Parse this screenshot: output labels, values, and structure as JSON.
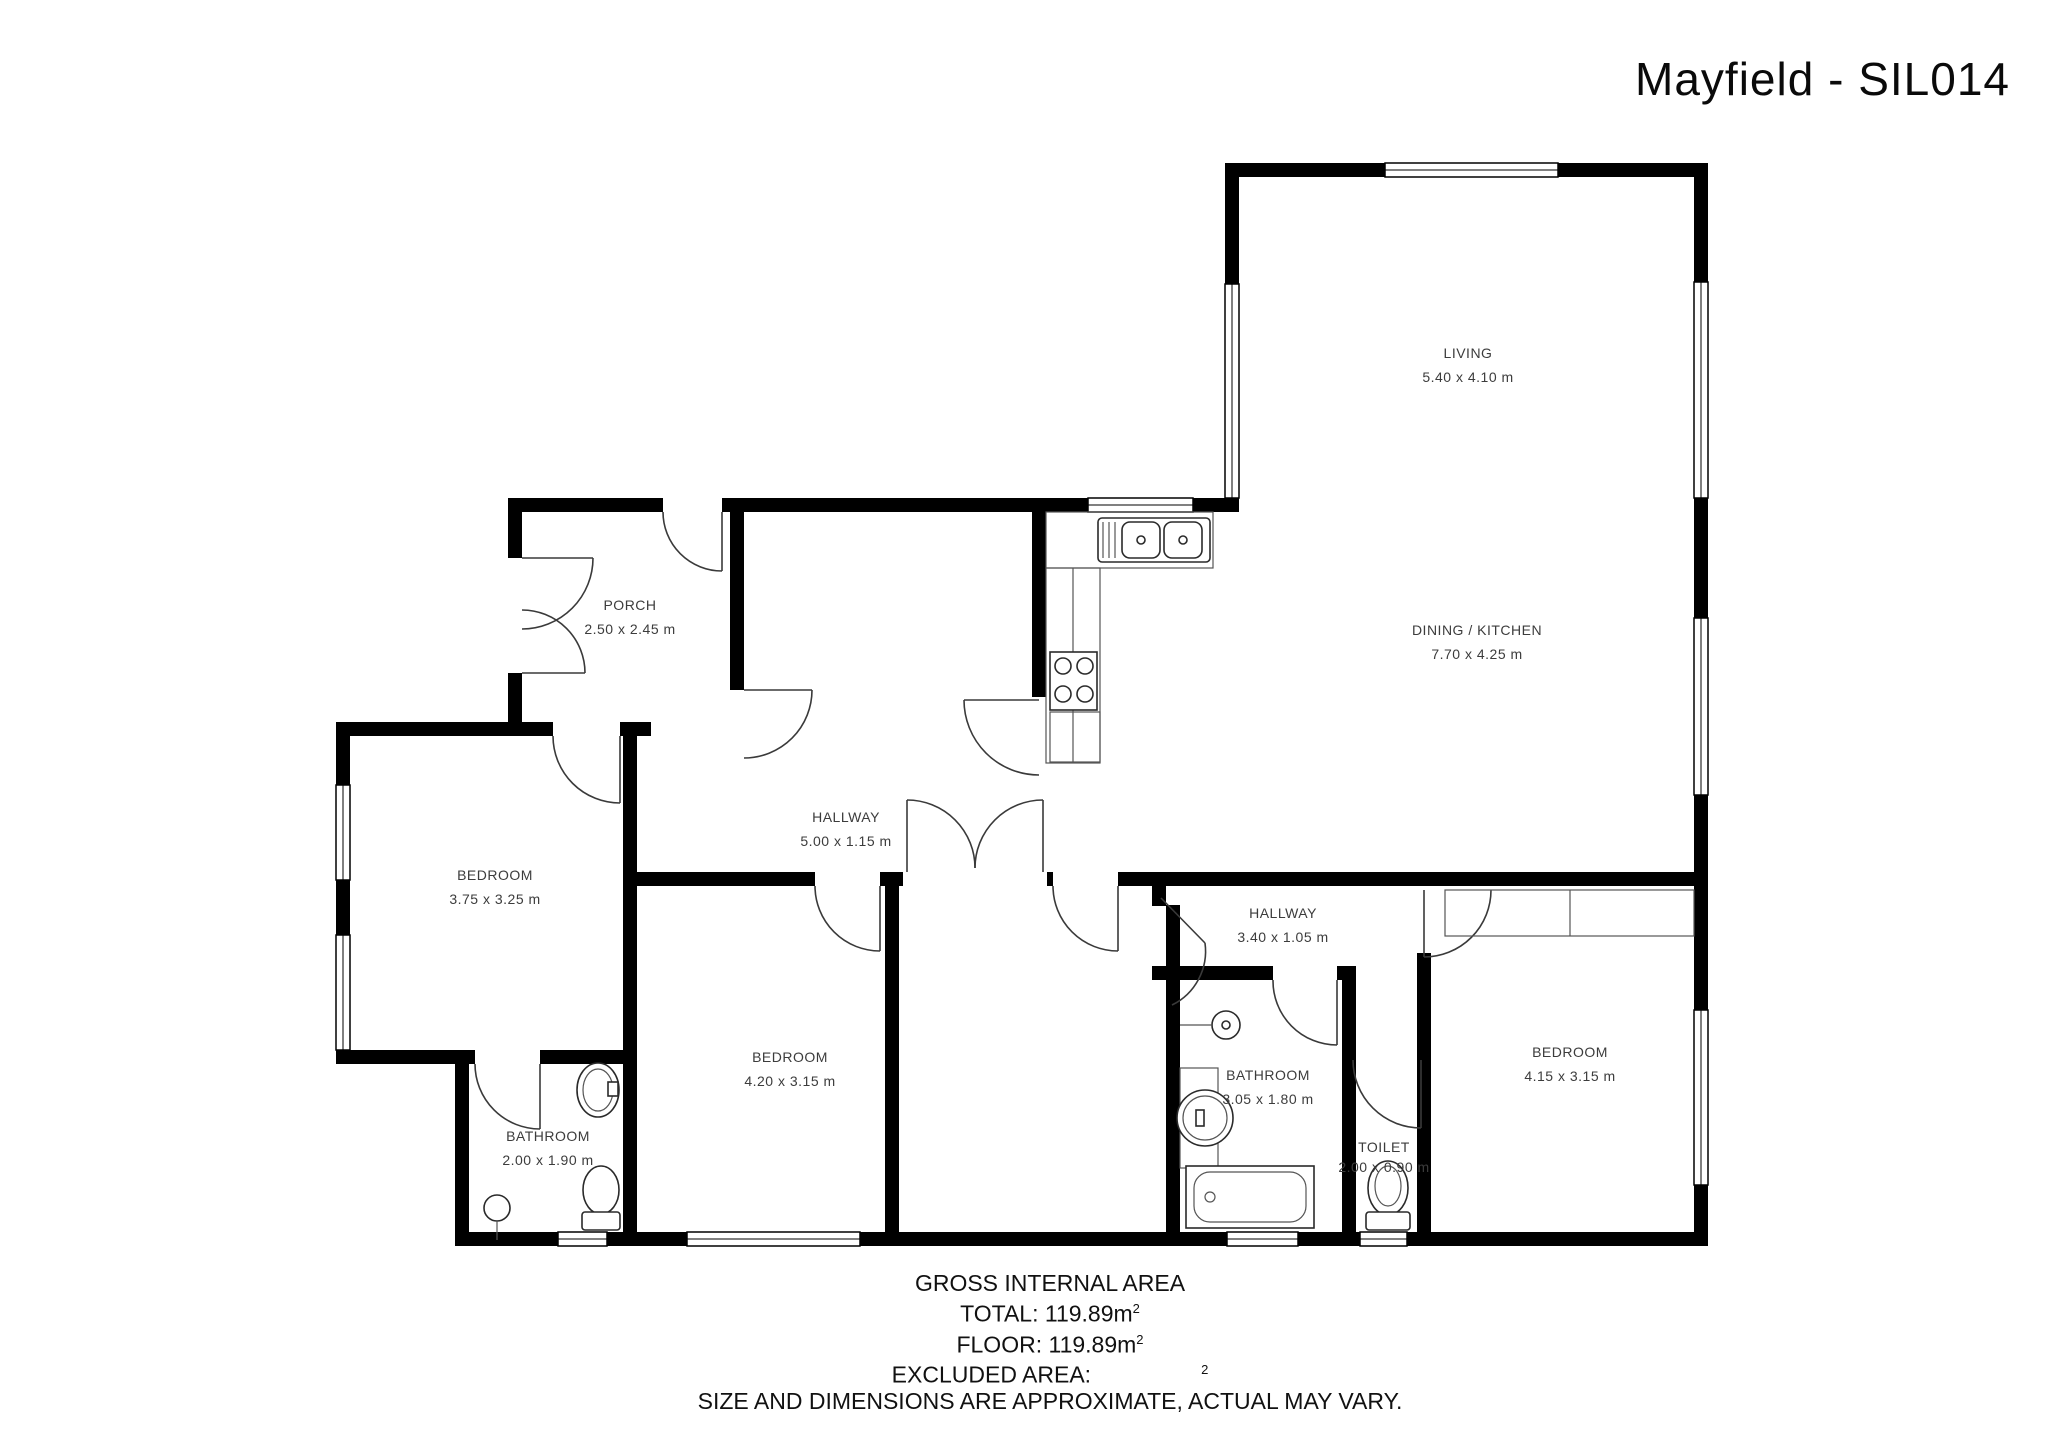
{
  "title": "Mayfield - SIL014",
  "rooms": [
    {
      "name": "LIVING",
      "dims": "5.40 x 4.10 m"
    },
    {
      "name": "DINING / KITCHEN",
      "dims": "7.70 x 4.25 m"
    },
    {
      "name": "PORCH",
      "dims": "2.50 x 2.45 m"
    },
    {
      "name": "HALLWAY",
      "dims": "5.00 x 1.15 m"
    },
    {
      "name": "HALLWAY",
      "dims": "3.40 x 1.05 m"
    },
    {
      "name": "BEDROOM",
      "dims": "3.75 x 3.25 m"
    },
    {
      "name": "BEDROOM",
      "dims": "4.20 x 3.15 m"
    },
    {
      "name": "BEDROOM",
      "dims": "4.15 x 3.15 m"
    },
    {
      "name": "BATHROOM",
      "dims": "2.00 x 1.90 m"
    },
    {
      "name": "BATHROOM",
      "dims": "3.05 x 1.80 m"
    },
    {
      "name": "TOILET",
      "dims": "2.00 x 0.90 m"
    }
  ],
  "footer": {
    "heading": "GROSS INTERNAL AREA",
    "total_label": "TOTAL: 119.89m",
    "floor_label": "FLOOR: 119.89m",
    "sup": "2",
    "excluded_label": "EXCLUDED AREA:",
    "excluded_sup": "2",
    "disclaimer": "SIZE AND DIMENSIONS ARE APPROXIMATE, ACTUAL MAY VARY."
  },
  "colors": {
    "wall": "#000000",
    "label": "#3c3c3c",
    "background": "#ffffff"
  }
}
